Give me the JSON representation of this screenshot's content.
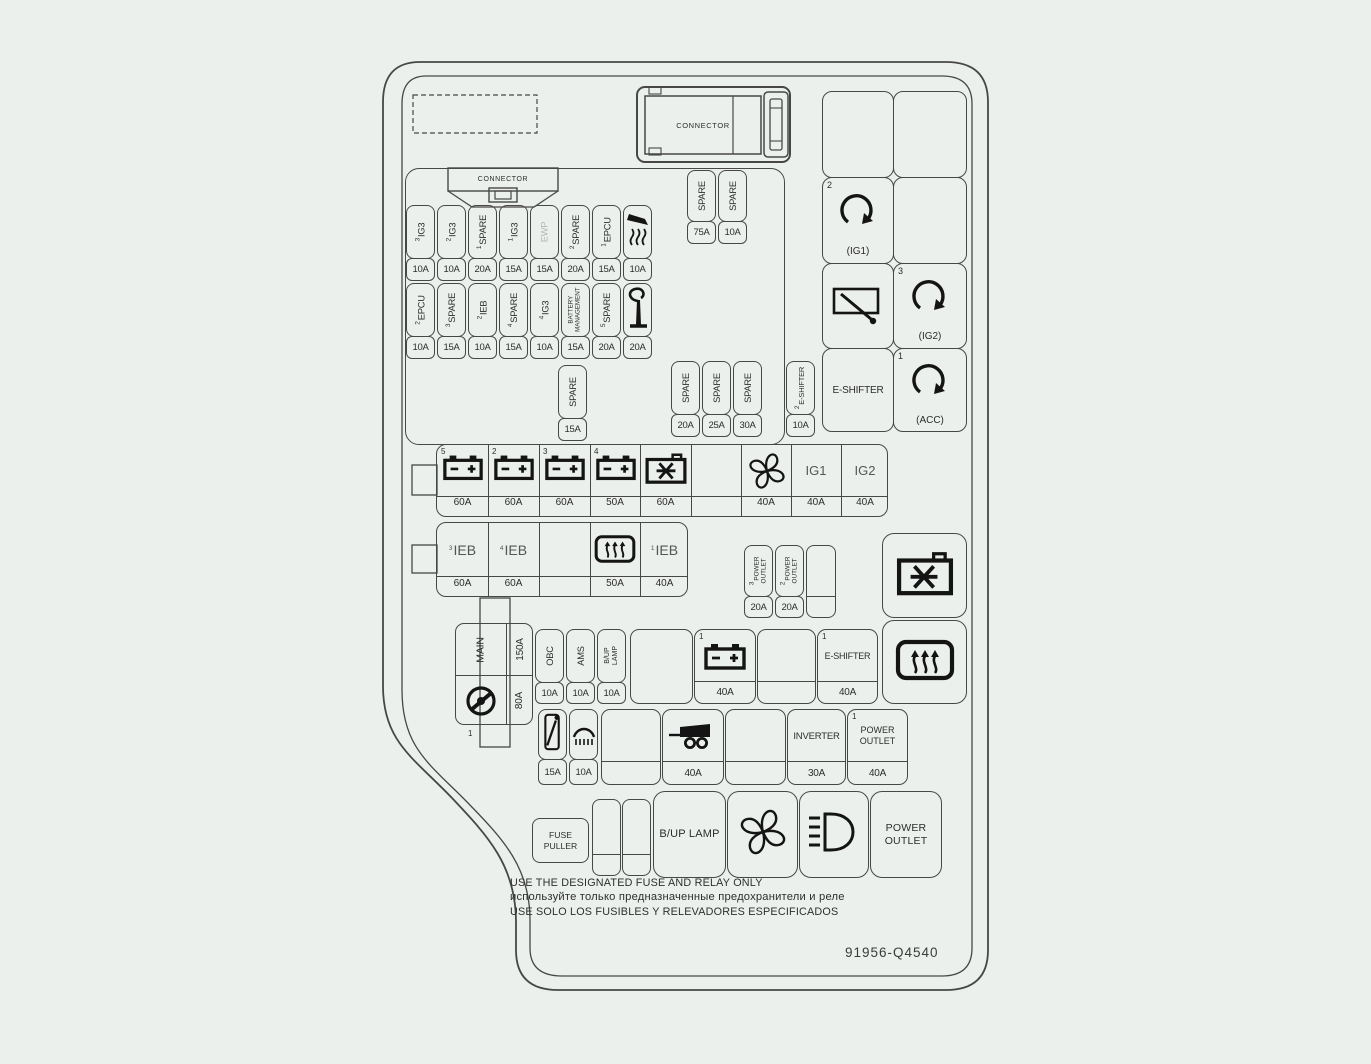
{
  "part_number": "91956-Q4540",
  "footer": {
    "en": "USE THE DESIGNATED FUSE AND RELAY ONLY",
    "ru": "используйте только предназначенные предохранители и реле",
    "es": "USE SOLO LOS FUSIBLES Y RELEVADORES ESPECIFICADOS"
  },
  "connectors": {
    "top": "CONNECTOR",
    "inner": "CONNECTOR"
  },
  "row1": [
    {
      "n": "3",
      "label": "IG3",
      "amp": "10A"
    },
    {
      "n": "2",
      "label": "IG3",
      "amp": "10A"
    },
    {
      "n": "1",
      "label": "SPARE",
      "amp": "20A"
    },
    {
      "n": "1",
      "label": "IG3",
      "amp": "15A"
    },
    {
      "label": "EWP",
      "amp": "15A"
    },
    {
      "n": "2",
      "label": "SPARE",
      "amp": "20A"
    },
    {
      "n": "1",
      "label": "EPCU",
      "amp": "15A"
    },
    {
      "icon": "heater",
      "amp": "10A"
    }
  ],
  "row2": [
    {
      "n": "2",
      "label": "EPCU",
      "amp": "10A"
    },
    {
      "n": "3",
      "label": "SPARE",
      "amp": "15A"
    },
    {
      "n": "2",
      "label": "IEB",
      "amp": "10A"
    },
    {
      "n": "4",
      "label": "SPARE",
      "amp": "15A"
    },
    {
      "n": "4",
      "label": "IG3",
      "amp": "10A"
    },
    {
      "label": "BATTERY MANAGEMENT",
      "amp": "15A"
    },
    {
      "n": "5",
      "label": "SPARE",
      "amp": "20A"
    },
    {
      "icon": "horn",
      "amp": "20A"
    }
  ],
  "spare_pair": [
    {
      "label": "SPARE",
      "amp": "75A"
    },
    {
      "label": "SPARE",
      "amp": "10A"
    }
  ],
  "spare_single": {
    "label": "SPARE",
    "amp": "15A"
  },
  "spare_trio": [
    {
      "label": "SPARE",
      "amp": "20A"
    },
    {
      "label": "SPARE",
      "amp": "25A"
    },
    {
      "label": "SPARE",
      "amp": "30A"
    }
  ],
  "eshifter_fuse": {
    "n": "2",
    "label": "E-SHIFTER",
    "amp": "10A"
  },
  "ignition": {
    "ig1": {
      "n": "2",
      "label": "(IG1)"
    },
    "ig2": {
      "n": "3",
      "label": "(IG2)"
    },
    "acc": {
      "n": "1",
      "label": "(ACC)"
    },
    "eshifter_relay": "E-SHIFTER"
  },
  "relay_row": {
    "cells": [
      {
        "n": "5",
        "icon": "battery",
        "amp": "60A"
      },
      {
        "n": "2",
        "icon": "battery",
        "amp": "60A"
      },
      {
        "n": "3",
        "icon": "battery",
        "amp": "60A"
      },
      {
        "n": "4",
        "icon": "battery",
        "amp": "50A"
      },
      {
        "icon": "ac-compressor",
        "amp": "60A"
      },
      {
        "amp": ""
      },
      {
        "icon": "fan",
        "amp": "40A"
      },
      {
        "label": "IG1",
        "amp": "40A"
      },
      {
        "label": "IG2",
        "amp": "40A"
      }
    ]
  },
  "ieb_row": [
    {
      "n": "3",
      "label": "IEB",
      "amp": "60A"
    },
    {
      "n": "4",
      "label": "IEB",
      "amp": "60A"
    },
    {
      "amp": ""
    },
    {
      "icon": "defroster",
      "amp": "50A"
    },
    {
      "n": "1",
      "label": "IEB",
      "amp": "40A"
    }
  ],
  "power_outlet_fuses": [
    {
      "n": "3",
      "label": "POWER OUTLET",
      "amp": "20A"
    },
    {
      "n": "2",
      "label": "POWER OUTLET",
      "amp": "20A"
    }
  ],
  "main_block": {
    "label": "MAIN",
    "amp": "150A",
    "eps_n": "1",
    "eps_amp": "80A"
  },
  "row_c": [
    {
      "label": "OBC",
      "amp": "10A"
    },
    {
      "label": "AMS",
      "amp": "10A"
    },
    {
      "label": "B/UP LAMP",
      "amp": "10A"
    },
    {
      "n": "1",
      "icon": "battery",
      "amp": "40A"
    },
    {
      "n": "1",
      "label": "E-SHIFTER",
      "amp": "40A"
    }
  ],
  "row_d": [
    {
      "icon": "rear-wiper",
      "amp": "15A"
    },
    {
      "icon": "lamp",
      "amp": "10A"
    },
    {
      "icon": "trailer",
      "amp": "40A"
    },
    {
      "label": "INVERTER",
      "amp": "30A"
    },
    {
      "n": "1",
      "label": "POWER OUTLET",
      "amp": "40A"
    }
  ],
  "bottom_row": {
    "fuse_puller": "FUSE PULLER",
    "bup_lamp": "B/UP LAMP",
    "power_outlet": "POWER OUTLET"
  }
}
